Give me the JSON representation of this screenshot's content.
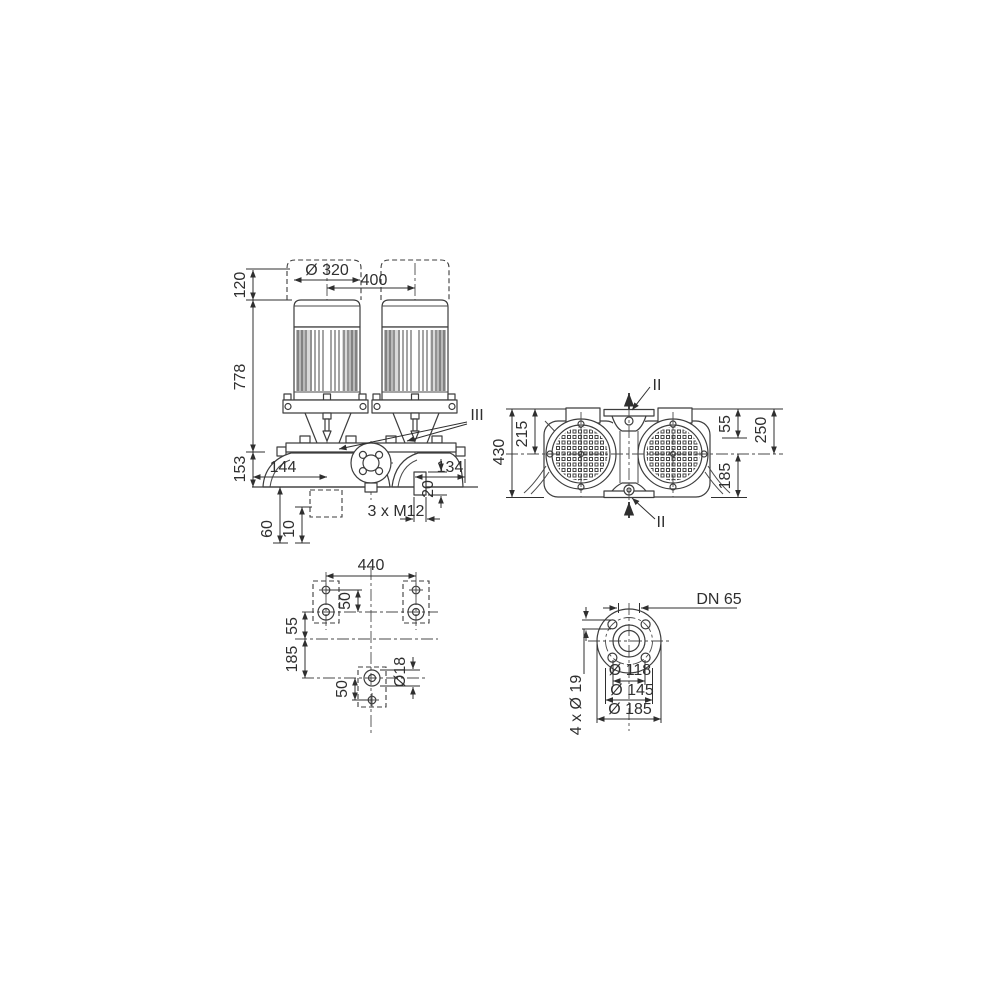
{
  "meta": {
    "drawing_type": "pump-dimension-drawing",
    "colors": {
      "line": "#3d3d3d",
      "dimension_text": "#2f2f2f",
      "background": "#ffffff",
      "rib_shading": "#b9b9b9"
    }
  },
  "front_view": {
    "d120": "120",
    "dia320": "Ø 320",
    "d400": "400",
    "d778": "778",
    "d153": "153",
    "d144": "144",
    "d134": "134",
    "d20": "20",
    "m12_label": "3 x M12",
    "d60": "60",
    "d10": "10",
    "iii_label": "III"
  },
  "top_view": {
    "d430": "430",
    "d215": "215",
    "d55": "55",
    "d250": "250",
    "d185": "185",
    "ii_top": "II",
    "ii_bottom": "II"
  },
  "foundation_view": {
    "d440": "440",
    "d50_upper": "50",
    "d55": "55",
    "d185": "185",
    "d50_lower": "50",
    "dia18": "Ø18"
  },
  "flange_view": {
    "dn65": "DN 65",
    "dia118": "Ø 118",
    "dia145": "Ø 145",
    "dia185": "Ø 185",
    "bolts_label": "4 x Ø 19"
  }
}
